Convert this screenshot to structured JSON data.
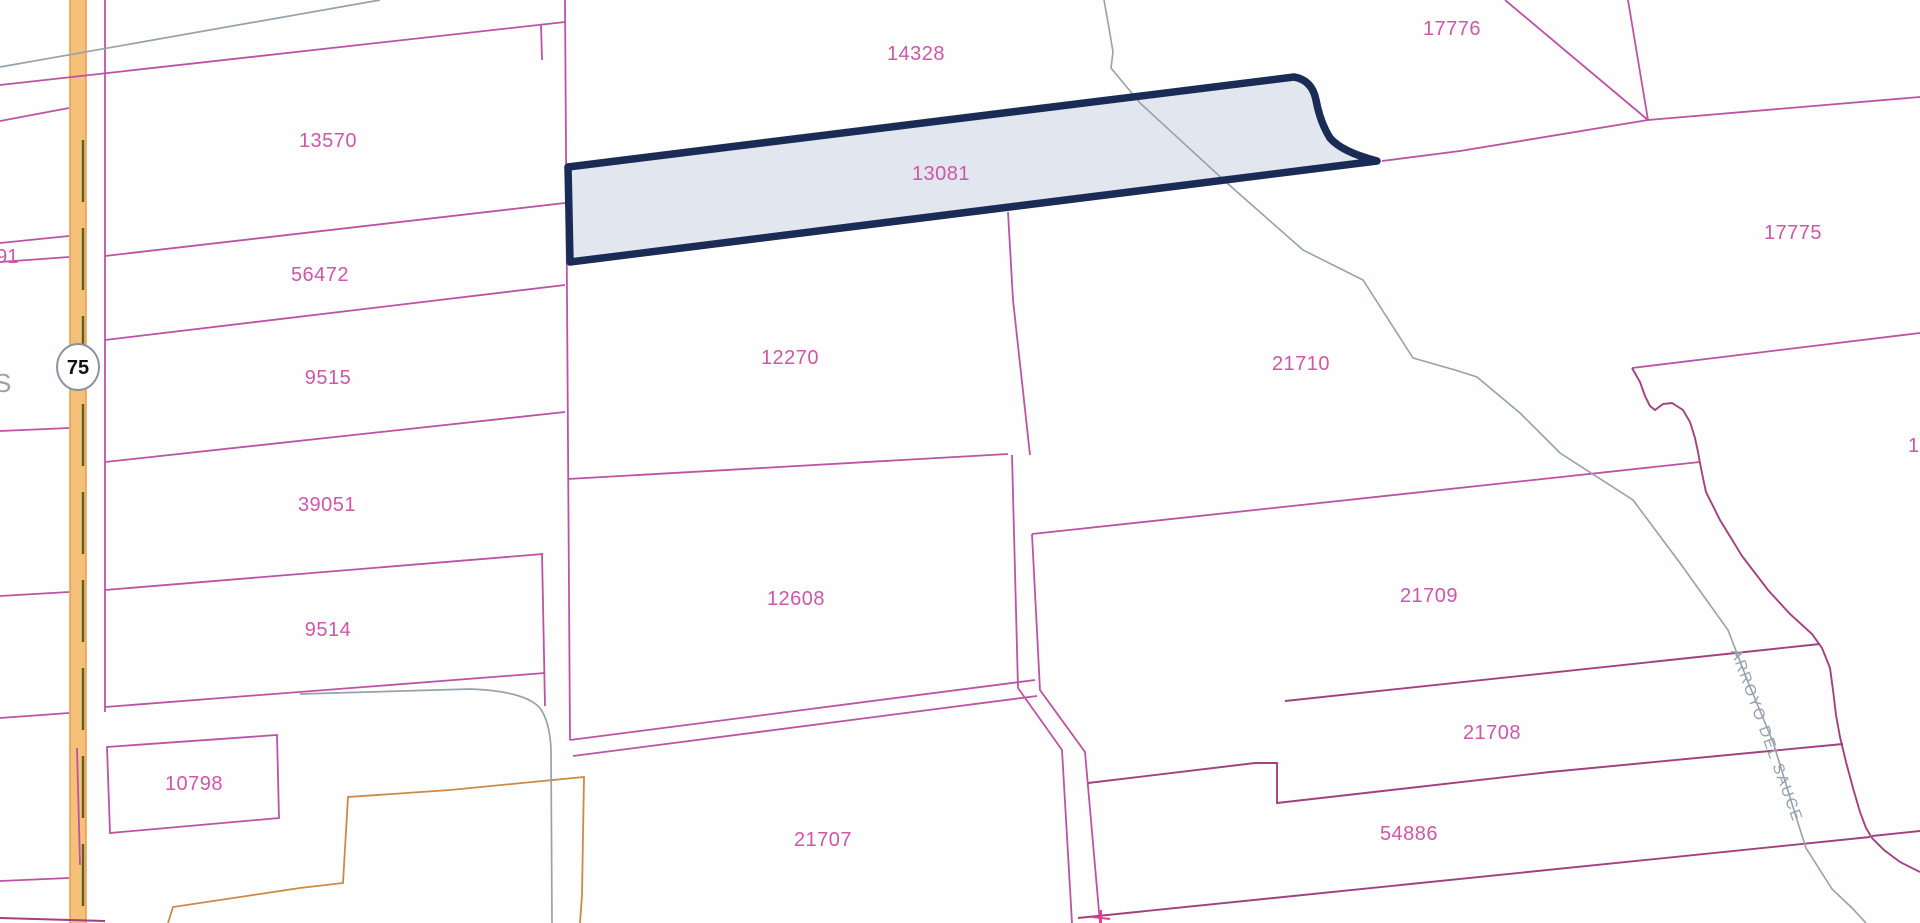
{
  "map": {
    "colors": {
      "background": "#fefefe",
      "line_pink": "#bd53a4",
      "line_dark": "#a2417f",
      "label_pink": "#cf56a8",
      "gray_line": "#98a2ab",
      "stream": "#96a1ac",
      "orange_line": "#cc8a45",
      "road_fill": "#f5c078",
      "road_edge": "#e59b4e",
      "road_centerline": "#5e5e20",
      "selected_border": "#1a2c55",
      "selected_fill": "#e2e6ef"
    },
    "selected_parcel": {
      "id": "13081",
      "label_x": 941,
      "label_y": 180
    },
    "parcel_labels": [
      {
        "id": "14328",
        "x": 916,
        "y": 60
      },
      {
        "id": "17776",
        "x": 1452,
        "y": 35
      },
      {
        "id": "13570",
        "x": 328,
        "y": 147
      },
      {
        "id": "17775",
        "x": 1793,
        "y": 239
      },
      {
        "id": "56472",
        "x": 320,
        "y": 281
      },
      {
        "id": "9515",
        "x": 328,
        "y": 384
      },
      {
        "id": "12270",
        "x": 790,
        "y": 364
      },
      {
        "id": "21710",
        "x": 1301,
        "y": 370
      },
      {
        "id": "39051",
        "x": 327,
        "y": 511
      },
      {
        "id": "12608",
        "x": 796,
        "y": 605
      },
      {
        "id": "21709",
        "x": 1429,
        "y": 602
      },
      {
        "id": "9514",
        "x": 328,
        "y": 636
      },
      {
        "id": "21708",
        "x": 1492,
        "y": 739
      },
      {
        "id": "10798",
        "x": 194,
        "y": 790
      },
      {
        "id": "54886",
        "x": 1409,
        "y": 840
      },
      {
        "id": "21707",
        "x": 823,
        "y": 846
      }
    ],
    "partial_labels": [
      {
        "text": "591",
        "x": -15,
        "y": 263,
        "class": "partial-pink"
      },
      {
        "text": "S",
        "x": -6,
        "y": 392,
        "class": "partial-gray"
      },
      {
        "text": "17",
        "x": 1908,
        "y": 452,
        "class": "partial-pink"
      }
    ],
    "stream_label": {
      "text": "ARROYO DEL SAUCE",
      "x": 1762,
      "y": 737,
      "rotate": 70
    },
    "highway_shield": {
      "route": "75",
      "x": 78,
      "y": 367
    }
  }
}
